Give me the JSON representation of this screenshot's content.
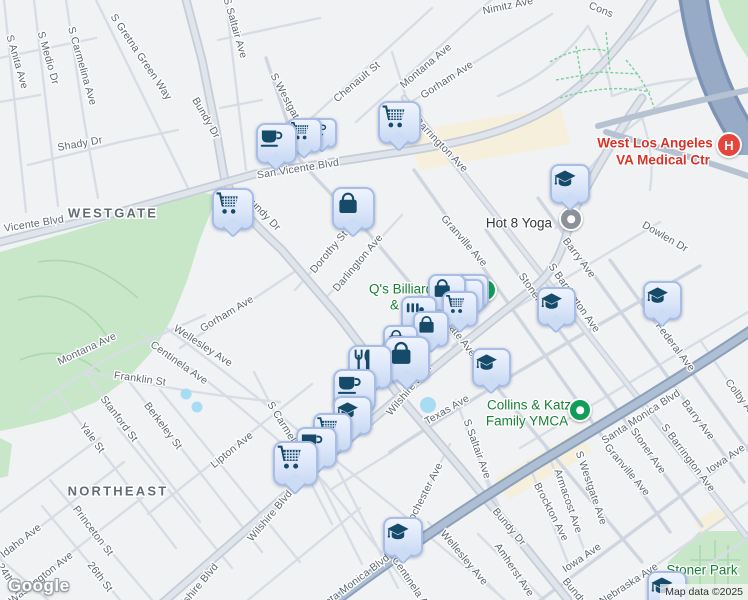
{
  "map": {
    "logo": "Google",
    "attribution": "Map data ©2025",
    "colors": {
      "background": "#f0f2f4",
      "park": "#c7e7c8",
      "pool": "#a7dcf4",
      "marker_fill": "#dbe6f9",
      "marker_border": "#a7bde6",
      "marker_icon": "#154a68",
      "poi_green": "#188038",
      "poi_red": "#da3125",
      "street_label": "#5c6670",
      "highway": "#97abc7"
    },
    "area_labels": [
      {
        "t": "WESTGATE",
        "x": 113,
        "y": 213
      },
      {
        "t": "NORTHEAST",
        "x": 118,
        "y": 491
      }
    ],
    "street_labels": [
      {
        "t": "S Anita Ave",
        "x": 17,
        "y": 62,
        "r": 74
      },
      {
        "t": "S Medio Dr",
        "x": 48,
        "y": 58,
        "r": 74
      },
      {
        "t": "S Carmelina Ave",
        "x": 82,
        "y": 66,
        "r": 74
      },
      {
        "t": "S Gretna Green Way",
        "x": 141,
        "y": 57,
        "r": 56
      },
      {
        "t": "Bundy Dr",
        "x": 206,
        "y": 118,
        "r": 60
      },
      {
        "t": "S Saltair Ave",
        "x": 235,
        "y": 28,
        "r": 74
      },
      {
        "t": "Shady Dr",
        "x": 80,
        "y": 144,
        "r": -10
      },
      {
        "t": "Vicente Blvd",
        "x": 34,
        "y": 224,
        "r": -9,
        "s": 12
      },
      {
        "t": "San Vicente Blvd",
        "x": 298,
        "y": 169,
        "r": -9,
        "s": 12
      },
      {
        "t": "Bundy Dr",
        "x": 263,
        "y": 213,
        "r": 46
      },
      {
        "t": "Chenault St",
        "x": 357,
        "y": 82,
        "r": -40
      },
      {
        "t": "Montana Ave",
        "x": 426,
        "y": 66,
        "r": -40
      },
      {
        "t": "Gorham Ave",
        "x": 447,
        "y": 80,
        "r": -33
      },
      {
        "t": "Barrington Ave",
        "x": 441,
        "y": 145,
        "r": 46
      },
      {
        "t": "Nimitz Ave",
        "x": 508,
        "y": 6,
        "r": -12
      },
      {
        "t": "Cons",
        "x": 601,
        "y": 10,
        "r": 22
      },
      {
        "t": "S Westgate Ave",
        "x": 291,
        "y": 108,
        "r": 62
      },
      {
        "t": "Dorothy St",
        "x": 329,
        "y": 252,
        "r": -50
      },
      {
        "t": "Darlington Ave",
        "x": 358,
        "y": 263,
        "r": -50
      },
      {
        "t": "Granville Ave",
        "x": 464,
        "y": 241,
        "r": 49
      },
      {
        "t": "S Westgate Ave",
        "x": 450,
        "y": 325,
        "r": 52
      },
      {
        "t": "Wilshire Blvd",
        "x": 409,
        "y": 390,
        "r": -50,
        "s": 12
      },
      {
        "t": "Texas Ave",
        "x": 447,
        "y": 410,
        "r": -30
      },
      {
        "t": "S Saltair Ave",
        "x": 477,
        "y": 449,
        "r": 70
      },
      {
        "t": "Rochester Ave",
        "x": 424,
        "y": 495,
        "r": -63
      },
      {
        "t": "S Carmelina Ave",
        "x": 291,
        "y": 437,
        "r": 58
      },
      {
        "t": "Wilshire Blvd",
        "x": 270,
        "y": 516,
        "r": -50,
        "s": 12
      },
      {
        "t": "Wilshire Blvd",
        "x": 196,
        "y": 589,
        "r": -50,
        "s": 12
      },
      {
        "t": "Montana Ave",
        "x": 87,
        "y": 349,
        "r": -25
      },
      {
        "t": "Gorham Ave",
        "x": 227,
        "y": 314,
        "r": -31
      },
      {
        "t": "Wellesley Ave",
        "x": 203,
        "y": 346,
        "r": 33
      },
      {
        "t": "Centinela Ave",
        "x": 179,
        "y": 363,
        "r": 35
      },
      {
        "t": "Franklin St",
        "x": 140,
        "y": 379,
        "r": 8
      },
      {
        "t": "Stanford St",
        "x": 119,
        "y": 419,
        "r": 53
      },
      {
        "t": "Berkeley St",
        "x": 163,
        "y": 426,
        "r": 53
      },
      {
        "t": "Yale St",
        "x": 92,
        "y": 438,
        "r": 53
      },
      {
        "t": "Lipton Ave",
        "x": 232,
        "y": 450,
        "r": -39
      },
      {
        "t": "Princeton St",
        "x": 93,
        "y": 531,
        "r": 53
      },
      {
        "t": "Idaho Ave",
        "x": 21,
        "y": 541,
        "r": -38
      },
      {
        "t": "Washington Ave",
        "x": 41,
        "y": 578,
        "r": -38
      },
      {
        "t": "26th St",
        "x": 100,
        "y": 577,
        "r": 53
      },
      {
        "t": "24th St",
        "x": 9,
        "y": 579,
        "r": 56
      },
      {
        "t": "Wellesley Ave",
        "x": 464,
        "y": 558,
        "r": 50
      },
      {
        "t": "Centinela Ave",
        "x": 413,
        "y": 586,
        "r": 56
      },
      {
        "t": "Santa Monica Blvd",
        "x": 641,
        "y": 417,
        "r": -33,
        "s": 12
      },
      {
        "t": "Santa Monica Blvd",
        "x": 352,
        "y": 584,
        "r": -37,
        "s": 12
      },
      {
        "t": "Bundy Dr",
        "x": 509,
        "y": 527,
        "r": 50
      },
      {
        "t": "Bundy Dr",
        "x": 579,
        "y": 597,
        "r": 50
      },
      {
        "t": "S Westgate Ave",
        "x": 591,
        "y": 488,
        "r": 71
      },
      {
        "t": "Granville Ave",
        "x": 627,
        "y": 470,
        "r": 50
      },
      {
        "t": "Stoner Ave",
        "x": 536,
        "y": 296,
        "r": 55
      },
      {
        "t": "Stoner Ave",
        "x": 648,
        "y": 451,
        "r": 55
      },
      {
        "t": "S Barrington Ave",
        "x": 574,
        "y": 298,
        "r": 55
      },
      {
        "t": "S Barrington Ave",
        "x": 688,
        "y": 458,
        "r": 53
      },
      {
        "t": "Barry Ave",
        "x": 579,
        "y": 258,
        "r": 53
      },
      {
        "t": "Barry Ave",
        "x": 698,
        "y": 420,
        "r": 53
      },
      {
        "t": "Federal Ave",
        "x": 675,
        "y": 347,
        "r": 53
      },
      {
        "t": "Colby Ave",
        "x": 742,
        "y": 400,
        "r": 53
      },
      {
        "t": "Iowa Ave",
        "x": 726,
        "y": 459,
        "r": -34
      },
      {
        "t": "Iowa Ave",
        "x": 582,
        "y": 558,
        "r": -34
      },
      {
        "t": "Armacost Ave",
        "x": 568,
        "y": 501,
        "r": 71
      },
      {
        "t": "Brockton Ave",
        "x": 551,
        "y": 512,
        "r": 63
      },
      {
        "t": "Amherst Ave",
        "x": 514,
        "y": 570,
        "r": 56
      },
      {
        "t": "Nebraska Ave",
        "x": 629,
        "y": 584,
        "r": -33
      },
      {
        "t": "Dowlen Dr",
        "x": 665,
        "y": 237,
        "r": 30
      }
    ],
    "poi_labels": [
      {
        "t": "Hot 8 Yoga",
        "x": 552,
        "y": 223,
        "c": "dark",
        "a": "end",
        "s": 13.5
      },
      {
        "t": "Q's Billiards",
        "x": 369,
        "y": 289,
        "c": "green",
        "a": "start",
        "s": 13.5
      },
      {
        "t": "& R",
        "x": 390,
        "y": 305,
        "c": "green",
        "a": "start",
        "s": 13.5
      },
      {
        "t": "West Los Angeles",
        "x": 655,
        "y": 143,
        "c": "red",
        "a": "middle",
        "s": 15
      },
      {
        "t": "VA Medical Ctr",
        "x": 663,
        "y": 160,
        "c": "red",
        "a": "middle",
        "s": 15
      },
      {
        "t": "Collins & Katz",
        "x": 529,
        "y": 405,
        "c": "green",
        "a": "middle",
        "s": 13.5
      },
      {
        "t": "Family YMCA",
        "x": 527,
        "y": 421,
        "c": "green",
        "a": "middle",
        "s": 13.5
      },
      {
        "t": "Stoner Park",
        "x": 702,
        "y": 570,
        "c": "green",
        "a": "middle",
        "s": 14
      }
    ],
    "hospital": {
      "label": "H",
      "x": 727,
      "y": 143,
      "r": 11
    },
    "dots": [
      {
        "name": "hot-8-yoga-dot",
        "x": 569,
        "y": 217,
        "r": 10,
        "c": "#8a9199"
      },
      {
        "name": "qs-billiards-dot",
        "x": 483,
        "y": 288,
        "r": 10,
        "c": "#109d58"
      },
      {
        "name": "ymca-dot",
        "x": 578,
        "y": 408,
        "r": 10,
        "c": "#109d58"
      }
    ],
    "markers": [
      {
        "icon": "shopping-cart",
        "x": 233,
        "y": 209,
        "s": 42
      },
      {
        "icon": "coffee-cup",
        "x": 322,
        "y": 133,
        "s": 30
      },
      {
        "icon": "shopping-cart",
        "x": 304,
        "y": 135,
        "s": 35
      },
      {
        "icon": "coffee-cup",
        "x": 276,
        "y": 143,
        "s": 41
      },
      {
        "icon": "shopping-cart",
        "x": 399,
        "y": 122,
        "s": 43
      },
      {
        "icon": "shopping-bag",
        "x": 353,
        "y": 208,
        "s": 43
      },
      {
        "icon": "graduation-cap",
        "x": 570,
        "y": 184,
        "s": 40
      },
      {
        "icon": "graduation-cap",
        "x": 556,
        "y": 306,
        "s": 39
      },
      {
        "icon": "graduation-cap",
        "x": 662,
        "y": 300,
        "s": 39
      },
      {
        "icon": "graduation-cap",
        "x": 491,
        "y": 367,
        "s": 39
      },
      {
        "icon": "graduation-cap",
        "x": 403,
        "y": 537,
        "s": 40
      },
      {
        "icon": "graduation-cap",
        "x": 667,
        "y": 591,
        "s": 40
      },
      {
        "icon": "stacked",
        "x": 472,
        "y": 291,
        "s": 34
      },
      {
        "icon": "stacked",
        "x": 467,
        "y": 296,
        "s": 34
      },
      {
        "icon": "shopping-bag",
        "x": 447,
        "y": 293,
        "s": 38
      },
      {
        "icon": "shopping-cart",
        "x": 460,
        "y": 309,
        "s": 36
      },
      {
        "icon": "grill",
        "x": 419,
        "y": 314,
        "s": 36
      },
      {
        "icon": "shopping-bag",
        "x": 431,
        "y": 329,
        "s": 36
      },
      {
        "icon": "shopping-bag",
        "x": 400,
        "y": 342,
        "s": 35
      },
      {
        "icon": "shopping-bag",
        "x": 407,
        "y": 359,
        "s": 46
      },
      {
        "icon": "restaurant",
        "x": 370,
        "y": 367,
        "s": 44
      },
      {
        "icon": "coffee-cup",
        "x": 354,
        "y": 390,
        "s": 43
      },
      {
        "icon": "graduation-cap",
        "x": 352,
        "y": 415,
        "s": 39
      },
      {
        "icon": "shopping-cart",
        "x": 332,
        "y": 432,
        "s": 39
      },
      {
        "icon": "coffee-cup",
        "x": 316,
        "y": 447,
        "s": 41
      },
      {
        "icon": "shopping-cart",
        "x": 295,
        "y": 463,
        "s": 45
      }
    ]
  }
}
